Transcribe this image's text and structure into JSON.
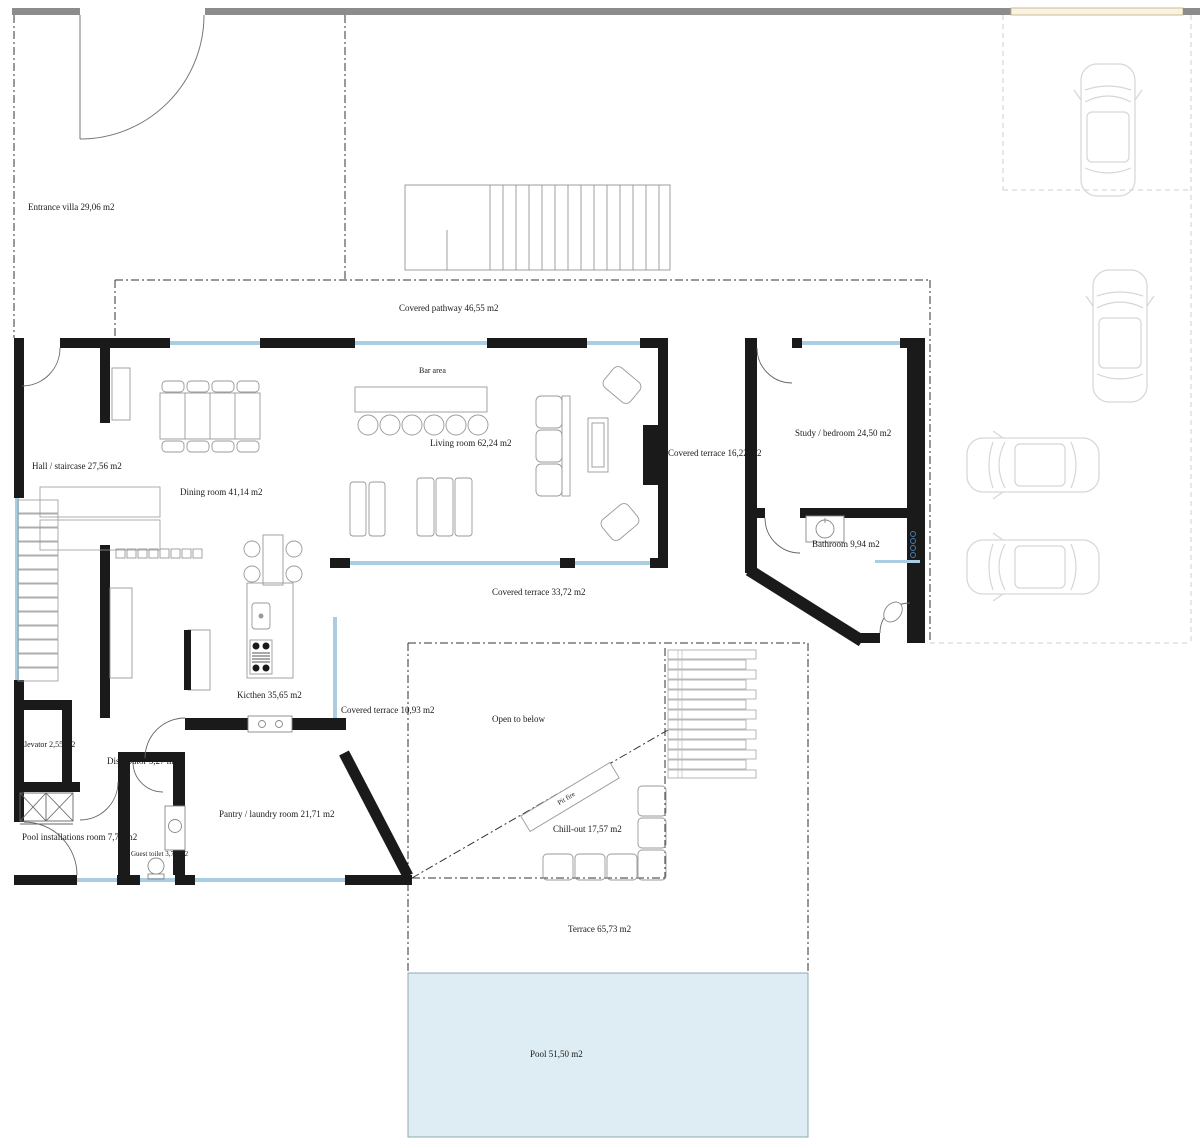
{
  "labels": {
    "entrance_villa": "Entrance villa 29,06 m2",
    "covered_pathway": "Covered pathway 46,55 m2",
    "bar_area": "Bar area",
    "living_room": "Living room 62,24 m2",
    "hall_staircase": "Hall / staircase 27,56 m2",
    "dining_room": "Dining room 41,14 m2",
    "chimney": "Chimney",
    "covered_terrace_east": "Covered terrace 16,22 m2",
    "study_bedroom": "Study / bedroom 24,50 m2",
    "bathroom": "Bathroom 9,94 m2",
    "covered_terrace_south": "Covered terrace 33,72 m2",
    "kitchen": "Kicthen 35,65 m2",
    "covered_terrace_small": "Covered terrace 10,93 m2",
    "open_to_below": "Open to below",
    "elevator": "Elevator 2,55 m2",
    "distributor": "Distributor 5,27 m2",
    "pantry_laundry": "Pantry / laundry room 21,71 m2",
    "pool_installations": "Pool installations room 7,75 m2",
    "guest_toilet": "Guest toilet 3,75 m2",
    "pit_fire": "Pit fire",
    "chill_out": "Chill-out 17,57 m2",
    "terrace": "Terrace 65,73 m2",
    "pool": "Pool 51,50 m2"
  },
  "colors": {
    "wall": "#1a1a1a",
    "boundary_wall_gray": "#8c8c8c",
    "gate_fill": "#f7f2e2",
    "window_glass": "#a9cee2",
    "pool_water": "#ddedf3",
    "furniture_outline": "#999999",
    "car_outline": "#d6d6d6"
  }
}
